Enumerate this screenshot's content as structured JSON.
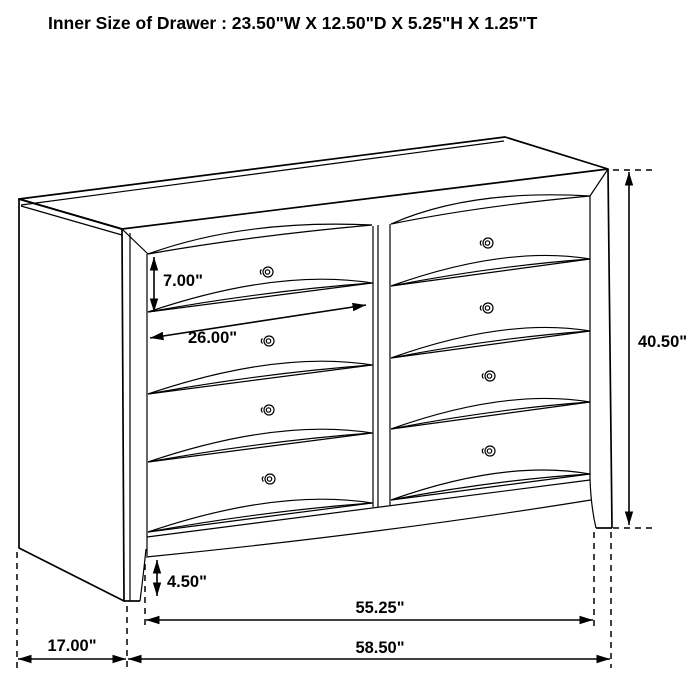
{
  "title": "Inner Size of Drawer : 23.50\"W X 12.50\"D X 5.25\"H X 1.25\"T",
  "diagram": {
    "type": "furniture-dimension-line-drawing",
    "subject": "eight-drawer dresser",
    "inner_drawer_size": {
      "width": "23.50\"",
      "depth": "12.50\"",
      "height": "5.25\"",
      "thickness": "1.25\""
    },
    "dimensions": {
      "drawer_opening_height": "7.00\"",
      "drawer_width": "26.00\"",
      "overall_height": "40.50\"",
      "base_height": "4.50\"",
      "case_width": "55.25\"",
      "overall_width": "58.50\"",
      "depth": "17.00\""
    }
  },
  "colors": {
    "line": "#000000",
    "background": "#ffffff",
    "text": "#000000"
  }
}
